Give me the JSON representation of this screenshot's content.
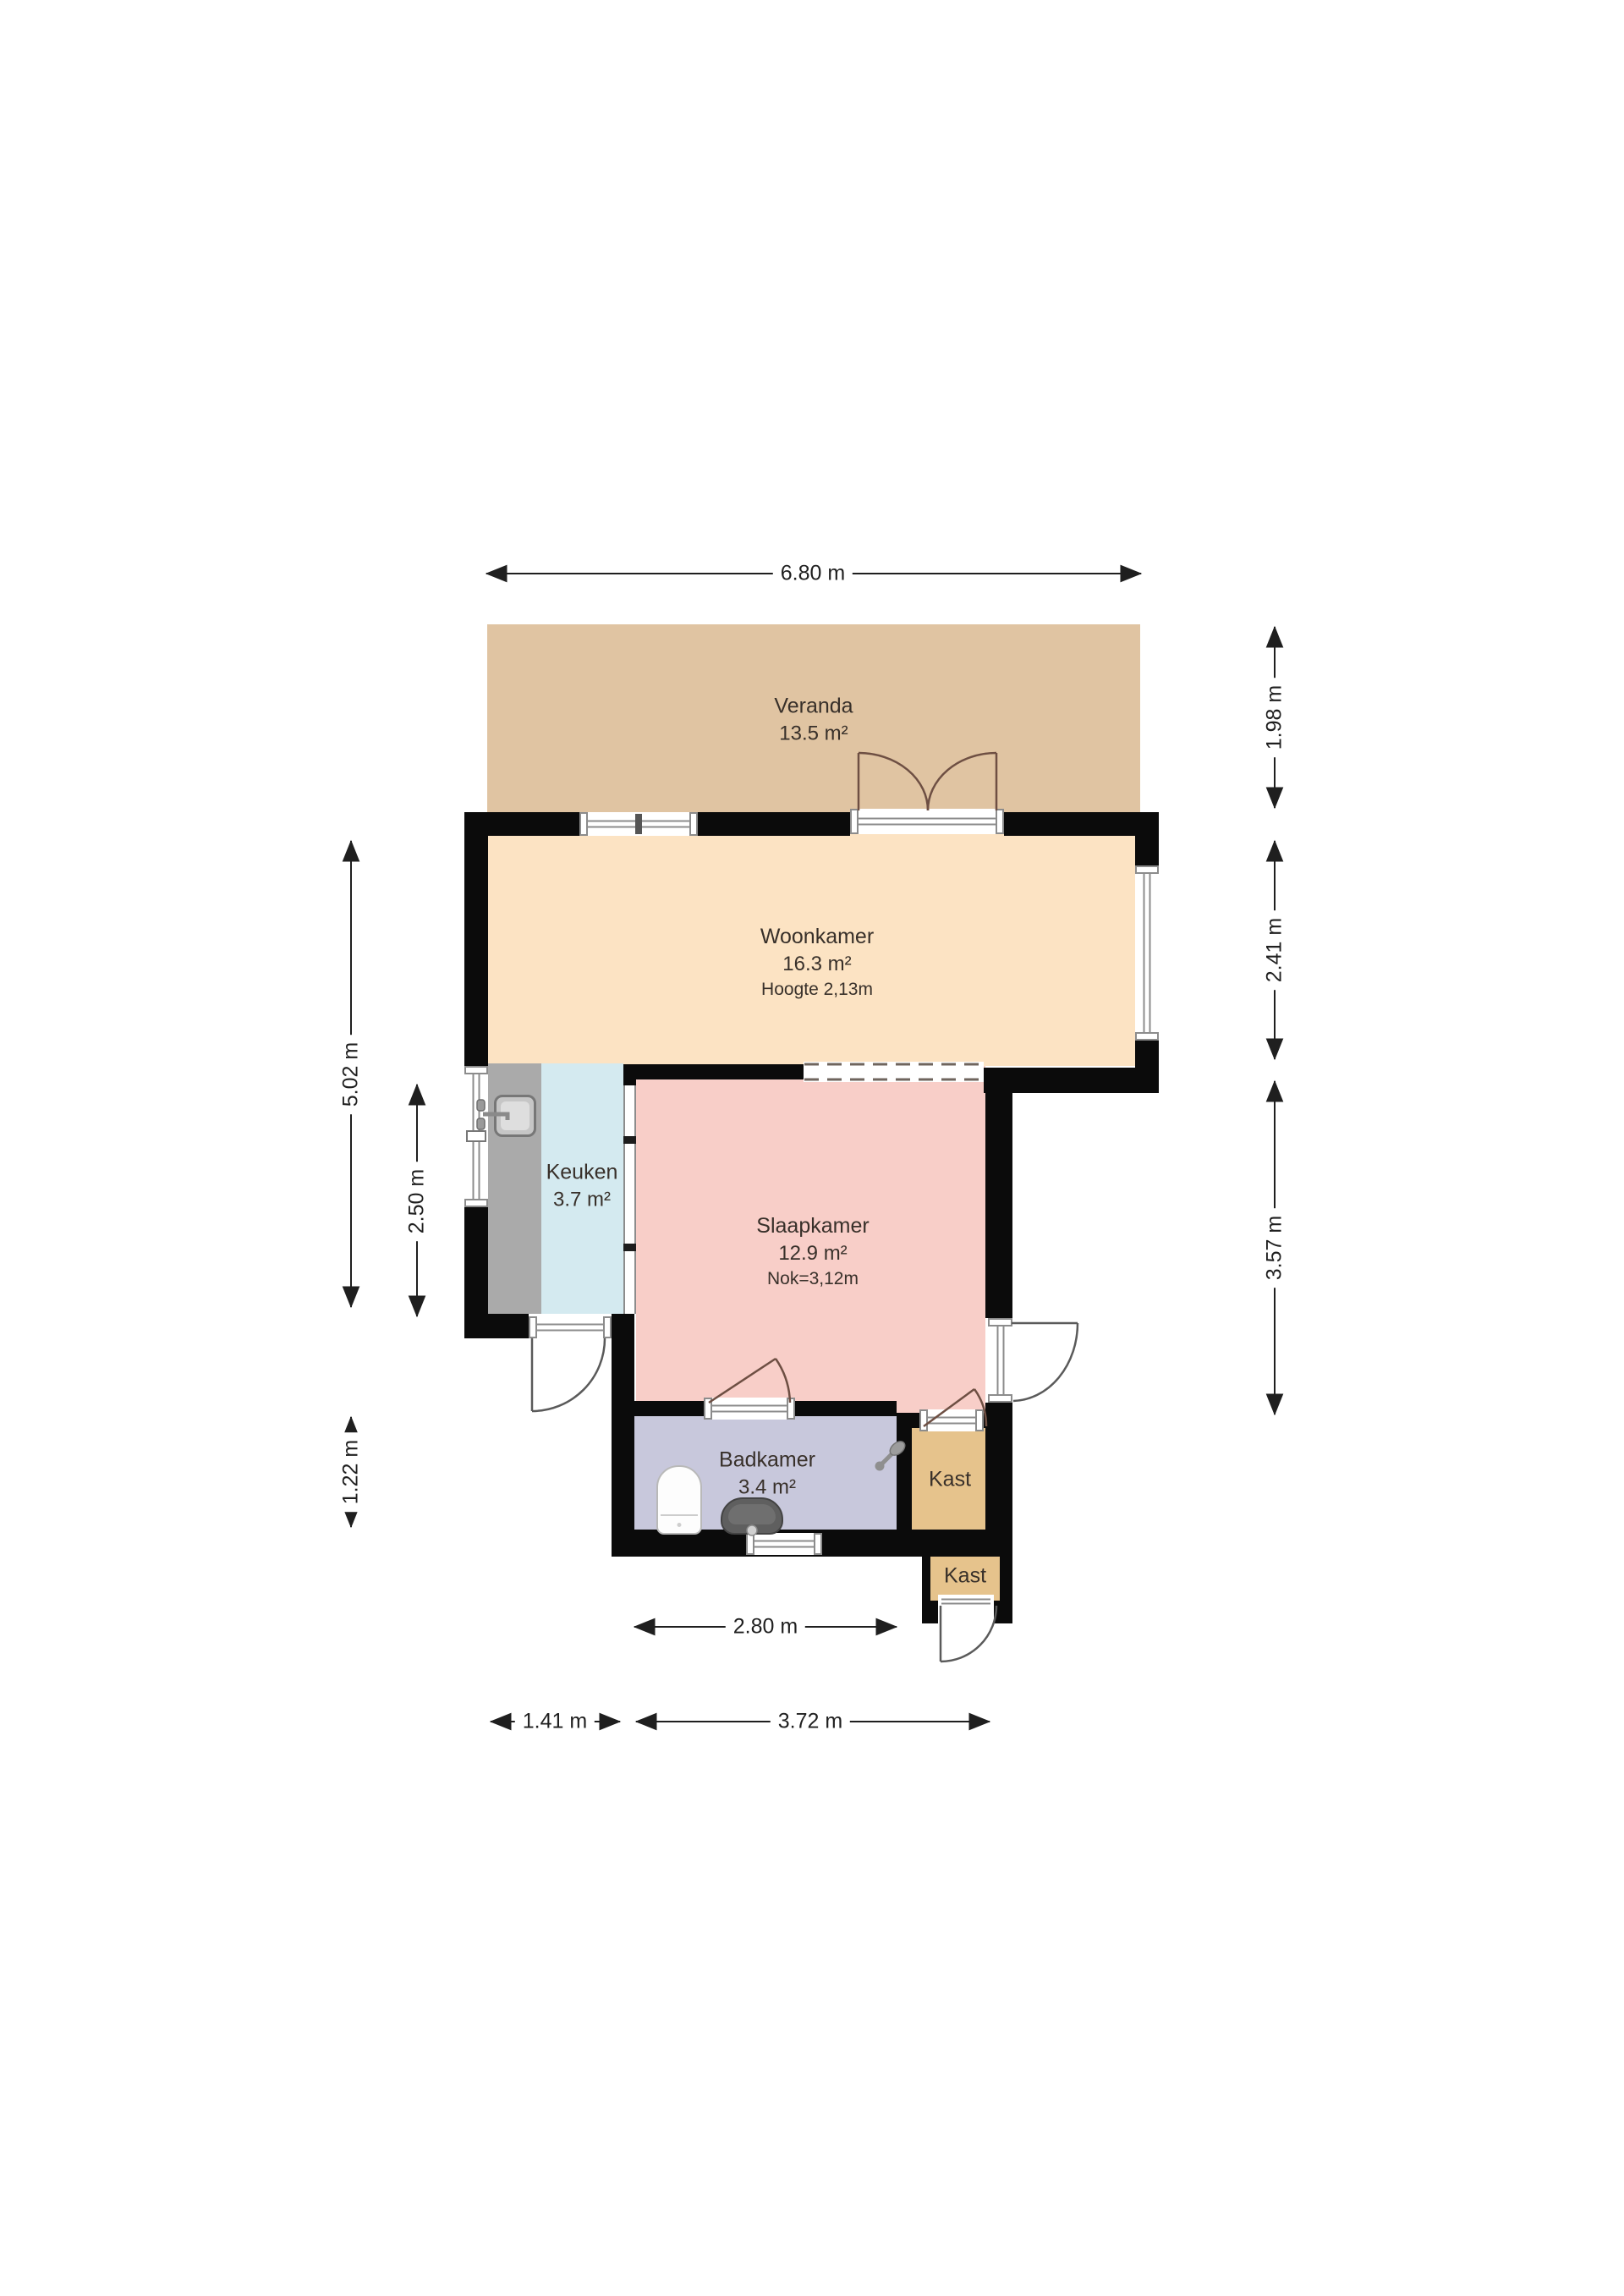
{
  "floorplan": {
    "wall_color": "#0b0b0b",
    "rooms": {
      "veranda": {
        "name": "Veranda",
        "area": "13.5 m²",
        "color": "#e0c4a2"
      },
      "woonkamer": {
        "name": "Woonkamer",
        "area": "16.3 m²",
        "note": "Hoogte 2,13m",
        "color": "#fce3c3"
      },
      "keuken": {
        "name": "Keuken",
        "area": "3.7 m²",
        "color": "#d4eaf0"
      },
      "slaapkamer": {
        "name": "Slaapkamer",
        "area": "12.9 m²",
        "note": "Nok=3,12m",
        "color": "#f8cec8"
      },
      "badkamer": {
        "name": "Badkamer",
        "area": "3.4 m²",
        "color": "#c8c8dc"
      },
      "kast_boven": {
        "name": "Kast",
        "color": "#e6c38c"
      },
      "kast_onder": {
        "name": "Kast",
        "color": "#e6c38c"
      }
    },
    "counter_color": "#aaaaaa",
    "dimensions": {
      "breedte_totaal": "6.80 m",
      "veranda_diepte": "1.98 m",
      "woonkamer_diepte": "2.41 m",
      "slaapkamer_diepte": "3.57 m",
      "links_totaal": "5.02 m",
      "keuken_diepte": "2.50 m",
      "badkamer_diepte": "1.22 m",
      "badkamer_breedte": "2.80 m",
      "onder_links": "1.41 m",
      "onder_rechts": "3.72 m"
    },
    "fixtures": [
      "kitchen-sink-icon",
      "toilet-icon",
      "washbasin-icon",
      "shower-icon"
    ]
  }
}
